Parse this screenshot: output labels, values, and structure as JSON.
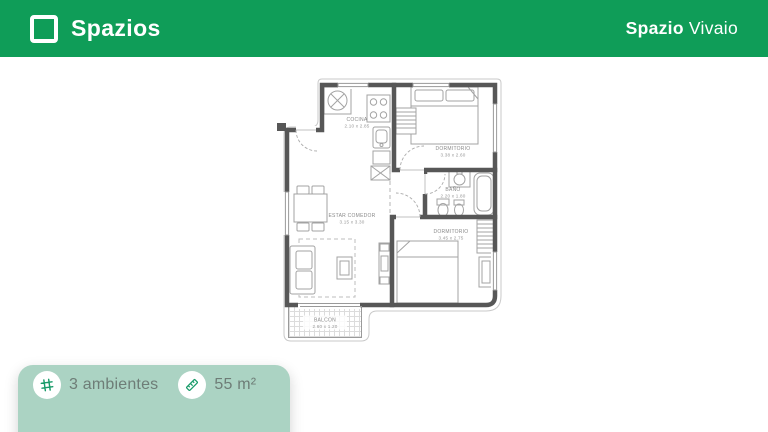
{
  "header": {
    "brand": "Spazios",
    "project": {
      "bold": "Spazio",
      "regular": "Vivaio"
    }
  },
  "plan": {
    "rooms": [
      {
        "name": "COCINA",
        "dims": "2.10 x 2.85"
      },
      {
        "name": "DORMITORIO",
        "dims": "3.38 x 2.60"
      },
      {
        "name": "BAÑO",
        "dims": "2.20 x 1.80"
      },
      {
        "name": "ESTAR COMEDOR",
        "dims": "3.15 x 3.30"
      },
      {
        "name": "DORMITORIO",
        "dims": "3.45 x 2.75"
      },
      {
        "name": "BALCON",
        "dims": "2.60 x 1.20"
      }
    ]
  },
  "footer": {
    "stats": [
      {
        "icon": "grid-hash-icon",
        "label": "3 ambientes"
      },
      {
        "icon": "ruler-icon",
        "label": "55 m²"
      }
    ]
  },
  "colors": {
    "header_green": "#0f9d58",
    "badge_mint": "#abd3c3",
    "icon_green": "#189b69",
    "stat_text": "#6e7d77",
    "wall": "#575757",
    "fixture": "#a3a3a3",
    "label": "#8a8a8a"
  }
}
